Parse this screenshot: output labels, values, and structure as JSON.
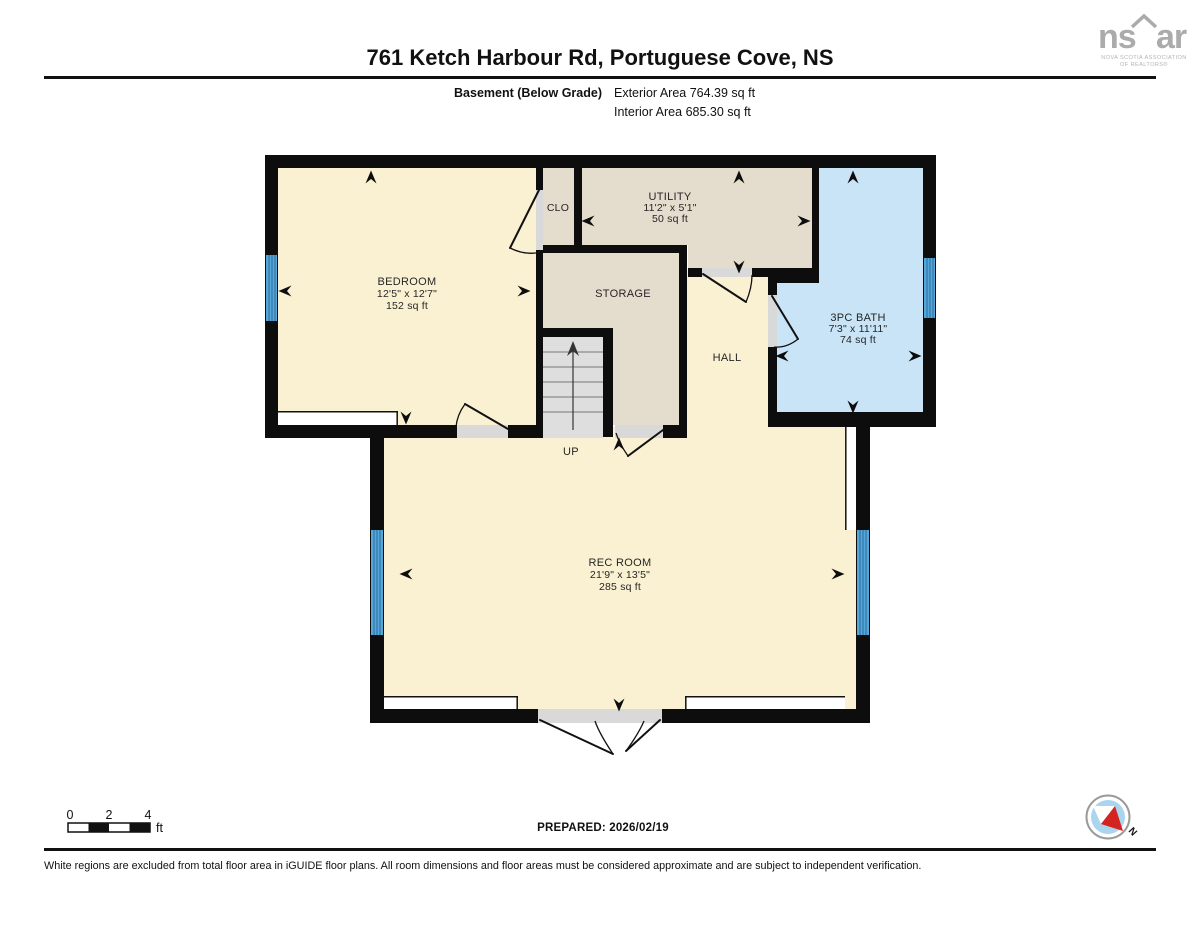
{
  "header": {
    "title": "761 Ketch Harbour Rd, Portuguese Cove, NS",
    "floor_label": "Basement (Below Grade)",
    "exterior_area": "Exterior Area 764.39 sq ft",
    "interior_area": "Interior Area 685.30 sq ft"
  },
  "logo": {
    "left": "ns",
    "right": "ar",
    "caption1": "NOVA SCOTIA ASSOCIATION",
    "caption2": "OF REALTORS®"
  },
  "rooms": {
    "bedroom": {
      "name": "BEDROOM",
      "dims": "12'5\" x 12'7\"",
      "area": "152 sq ft"
    },
    "closet": {
      "name": "CLO"
    },
    "utility": {
      "name": "UTILITY",
      "dims": "11'2\" x 5'1\"",
      "area": "50 sq ft"
    },
    "storage": {
      "name": "STORAGE"
    },
    "hall": {
      "name": "HALL"
    },
    "bath": {
      "name": "3PC BATH",
      "dims": "7'3\" x 11'11\"",
      "area": "74 sq ft"
    },
    "rec_room": {
      "name": "REC ROOM",
      "dims": "21'9\" x 13'5\"",
      "area": "285 sq ft"
    },
    "stairs": {
      "label": "UP"
    }
  },
  "scale_bar": {
    "tick0": "0",
    "tick1": "2",
    "tick2": "4",
    "unit": "ft"
  },
  "prepared": "PREPARED: 2026/02/19",
  "compass": {
    "label": "N"
  },
  "disclaimer": "White regions are excluded from total floor area in iGUIDE floor plans. All room dimensions and floor areas must be considered approximate and are subject to independent verification.",
  "colors": {
    "floor_cream": "#FAF1D2",
    "floor_beige": "#E4DCCC",
    "floor_bath_blue": "#C9E4F6",
    "wall_black": "#0D0D0D",
    "window_blue": "#54A7D8",
    "window_stripe": "#2A6E9E",
    "stair_gray": "#DEDEDE",
    "threshold_gray": "#D9D9D9",
    "compass_fill": "#ABD5EF",
    "compass_needle_red": "#D42421",
    "logo_gray": "#ABABAB"
  }
}
